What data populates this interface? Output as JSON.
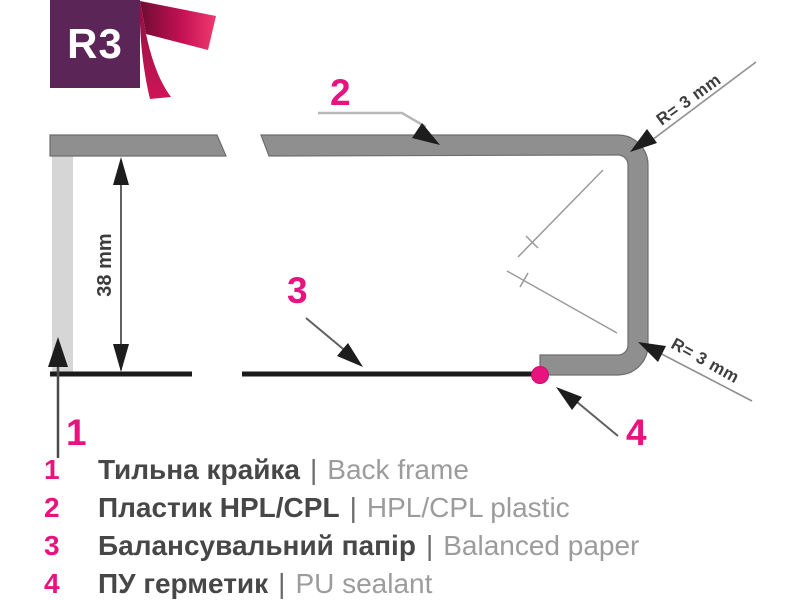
{
  "badge": {
    "label": "R3"
  },
  "diagram": {
    "height_dimension": "38 mm",
    "radius_top": "R= 3 mm",
    "radius_bottom": "R= 3 mm",
    "callout_1": "1",
    "callout_2": "2",
    "callout_3": "3",
    "callout_4": "4"
  },
  "legend": {
    "items": [
      {
        "num": "1",
        "uk": "Тильна крайка",
        "sep": "|",
        "en": "Back frame"
      },
      {
        "num": "2",
        "uk": "Пластик HPL/CPL",
        "sep": "|",
        "en": "HPL/CPL plastic"
      },
      {
        "num": "3",
        "uk": "Балансувальний папір",
        "sep": "|",
        "en": "Balanced paper"
      },
      {
        "num": "4",
        "uk": "ПУ герметик",
        "sep": "|",
        "en": "PU sealant"
      }
    ]
  },
  "colors": {
    "accent_pink": "#e8137f",
    "badge_purple": "#5c2558",
    "ribbon_dark": "#6f0c33",
    "ribbon_bright": "#ef3a6e",
    "profile_gray": "#8f8f8f",
    "back_edge_light_gray": "#d6d6d6",
    "line_black": "#1b1b1b",
    "text_dark": "#474747",
    "text_light": "#9c9c9c"
  }
}
